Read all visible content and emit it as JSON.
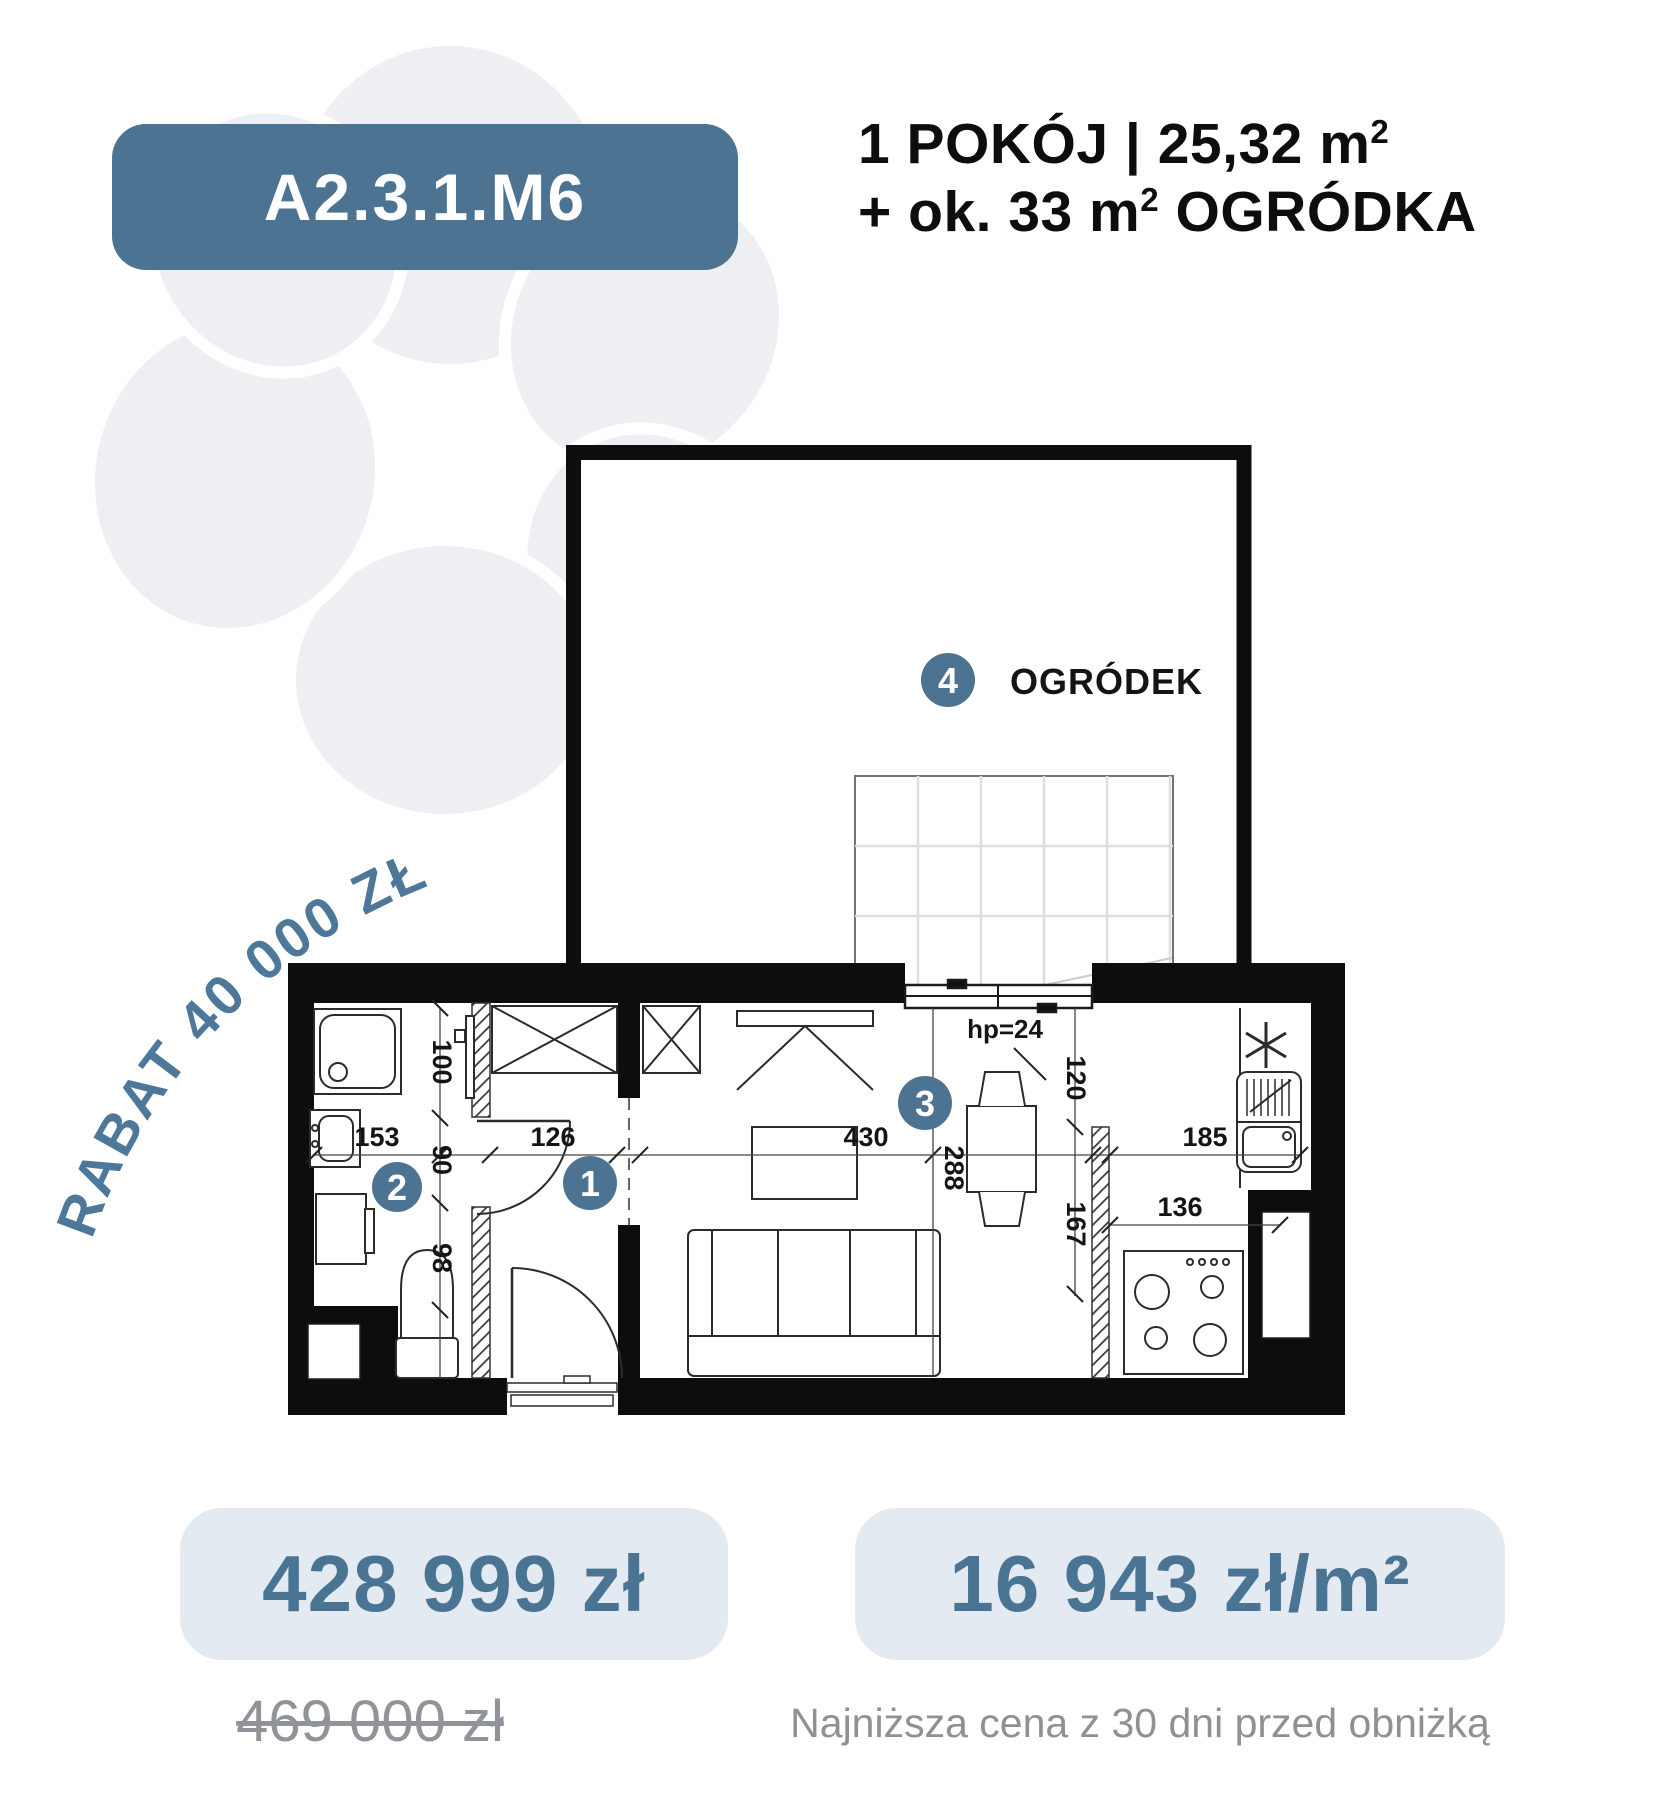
{
  "colors": {
    "accent": "#4d7392",
    "price_text": "#4a7494",
    "box_bg": "#e4eaf1",
    "muted_text": "#8d9194",
    "flower": "#edeff2",
    "plan_line": "#0d0d0d"
  },
  "badge": {
    "unit_id": "A2.3.1.M6"
  },
  "header": {
    "rooms_area": "1 POKÓJ | 25,32 m",
    "rooms_area_sup": "2",
    "garden_prefix": "+ ok. 33 m",
    "garden_sup": "2",
    "garden_suffix": " OGRÓDKA"
  },
  "discount": {
    "text": "RABAT 40 000 ZŁ"
  },
  "floor_plan": {
    "garden_label": "OGRÓDEK",
    "window_sill": "hp=24",
    "room_numbers": {
      "hall": "1",
      "bathroom": "2",
      "living": "3",
      "garden": "4"
    },
    "dimensions": {
      "bath_width": "153",
      "bath_top": "100",
      "bath_door": "90",
      "bath_bottom": "98",
      "hall_door": "126",
      "living_width": "430",
      "living_depth": "288",
      "kitchen_opening": "120",
      "kitchen_wall": "167",
      "kitchen_counter": "185",
      "kitchen_lower": "136"
    }
  },
  "pricing": {
    "price": "428 999 zł",
    "price_per_m2": "16 943 zł/m²",
    "old_price": "469 000 zł",
    "disclaimer": "Najniższa cena z 30 dni przed obniżką"
  }
}
